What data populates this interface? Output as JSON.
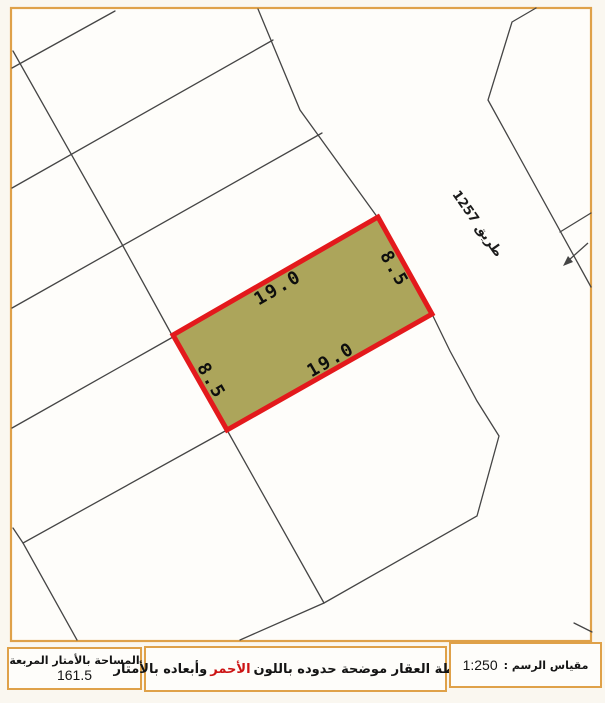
{
  "map": {
    "road_label": "طريق 1257",
    "parcel_dims": {
      "top": "19.0",
      "bottom": "19.0",
      "left": "8.5",
      "right": "8.5"
    },
    "area_value_sqm": "161.5",
    "scale": "1:250"
  },
  "footer": {
    "area_label": "المساحة بالأمتار المربعة",
    "area_value": "161.5",
    "desc_text_start": "خريطة العقار موضحة حدوده باللون",
    "desc_highlight": "الأحمر",
    "desc_text_end": "وأبعاده بالأمتار",
    "scale_label": "مقياس الرسم :",
    "scale_value": "1:250"
  },
  "colors": {
    "parcel_fill": "#aca55b",
    "parcel_border": "#e3191c",
    "frame_border": "#dfa149",
    "map_line": "#454545",
    "highlight_text": "#cc1414",
    "paper": "#faf7f0"
  }
}
